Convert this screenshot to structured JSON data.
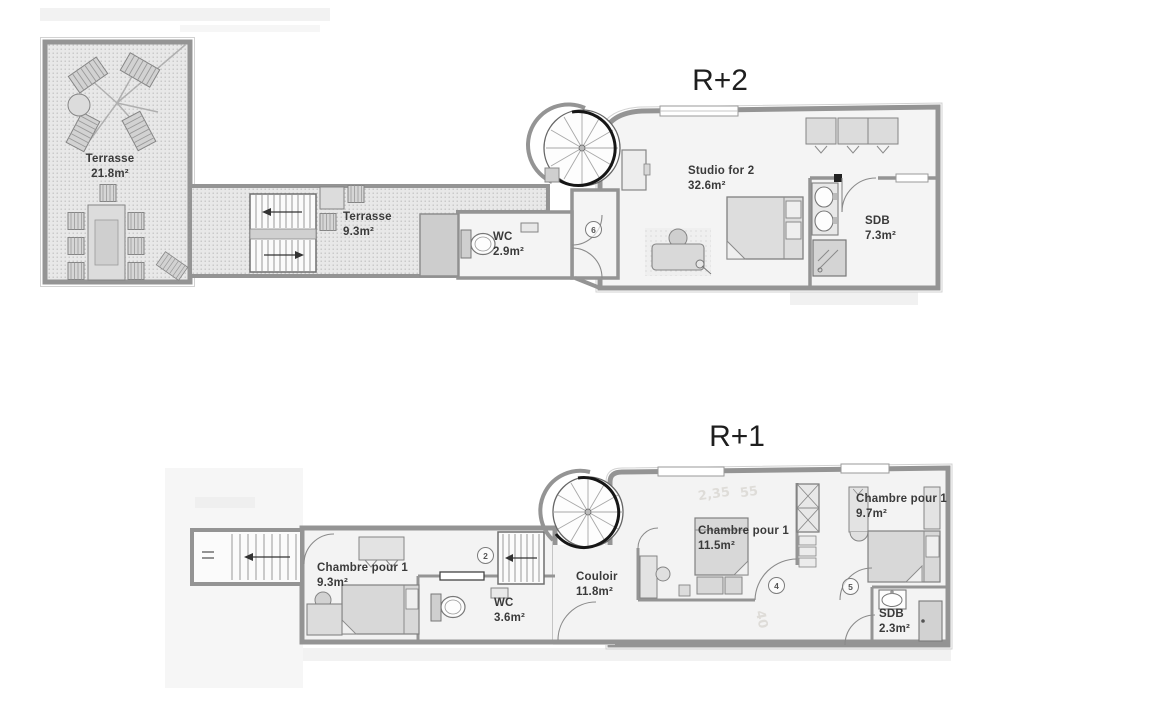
{
  "colors": {
    "wall": "#949494",
    "floor": "#f3f3f3",
    "terrace_fill": "#e8e8e8",
    "terrace_dot": "#bdbdbd",
    "furniture": "#d8d8d8",
    "label_text": "#3a3a3a",
    "title_text": "#1e1e1e",
    "background": "#ffffff"
  },
  "plans": [
    {
      "title": "R+2",
      "rooms": [
        {
          "name": "Terrasse",
          "area": "21.8m²"
        },
        {
          "name": "Terrasse",
          "area": "9.3m²"
        },
        {
          "name": "WC",
          "area": "2.9m²"
        },
        {
          "name": "Studio for 2",
          "area": "32.6m²"
        },
        {
          "name": "SDB",
          "area": "7.3m²"
        }
      ],
      "door_badges": [
        "6"
      ]
    },
    {
      "title": "R+1",
      "rooms": [
        {
          "name": "Chambre pour 1",
          "area": "9.3m²"
        },
        {
          "name": "WC",
          "area": "3.6m²"
        },
        {
          "name": "Couloir",
          "area": "11.8m²"
        },
        {
          "name": "Chambre pour 1",
          "area": "11.5m²"
        },
        {
          "name": "Chambre pour 1",
          "area": "9.7m²"
        },
        {
          "name": "SDB",
          "area": "2.3m²"
        }
      ],
      "door_badges": [
        "2",
        "4",
        "5"
      ],
      "annotations": [
        "2,35",
        "55",
        "40"
      ]
    }
  ]
}
